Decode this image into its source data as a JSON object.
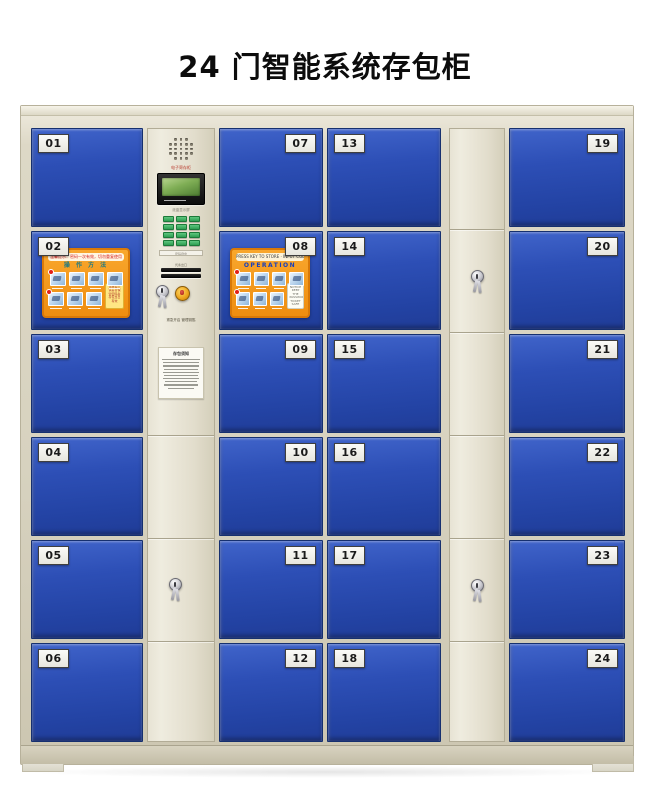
{
  "title": "24 门智能系统存包柜",
  "cabinet": {
    "frame_color": "#d8d3c0",
    "door_color": "#2b4cb0",
    "keypad_color": "#2f9e53",
    "stickers": {
      "cn": {
        "header": "温馨提示：密码一次有效，切勿重复使用",
        "title": "操 作 方 法",
        "note": "温馨提示 请妥善保管密码条 存包当日有效"
      },
      "en": {
        "header": "PRESS KEY TO STORE · INPUT CODE TO OPEN",
        "title": "OPERATION",
        "note": "NOTICE KEEP THE PASSWORD TICKET SAFE"
      }
    },
    "control_panel": {
      "brand": "电子寄存柜",
      "screen_note": "液晶显示屏",
      "keypad_label": "密码键盘",
      "slot_caption": "凭条出口",
      "emergency_caption": "紧急开启 管理钥匙",
      "notice_title": "存包须知"
    },
    "columns": [
      {
        "id": "doors-1",
        "type": "doors",
        "plate_side": "left",
        "doors": [
          {
            "num": "01"
          },
          {
            "num": "02",
            "sticker": "cn"
          },
          {
            "num": "03"
          },
          {
            "num": "04"
          },
          {
            "num": "05"
          },
          {
            "num": "06"
          }
        ]
      },
      {
        "id": "control",
        "type": "control"
      },
      {
        "id": "doors-2",
        "type": "doors",
        "plate_side": "right",
        "doors": [
          {
            "num": "07"
          },
          {
            "num": "08",
            "sticker": "en"
          },
          {
            "num": "09"
          },
          {
            "num": "10"
          },
          {
            "num": "11"
          },
          {
            "num": "12"
          }
        ]
      },
      {
        "id": "doors-3",
        "type": "doors",
        "plate_side": "left",
        "doors": [
          {
            "num": "13"
          },
          {
            "num": "14"
          },
          {
            "num": "15"
          },
          {
            "num": "16"
          },
          {
            "num": "17"
          },
          {
            "num": "18"
          }
        ]
      },
      {
        "id": "side",
        "type": "narrow",
        "lock_rows": [
          1,
          4
        ]
      },
      {
        "id": "doors-4",
        "type": "doors",
        "plate_side": "right",
        "doors": [
          {
            "num": "19"
          },
          {
            "num": "20"
          },
          {
            "num": "21"
          },
          {
            "num": "22"
          },
          {
            "num": "23"
          },
          {
            "num": "24"
          }
        ]
      }
    ]
  }
}
